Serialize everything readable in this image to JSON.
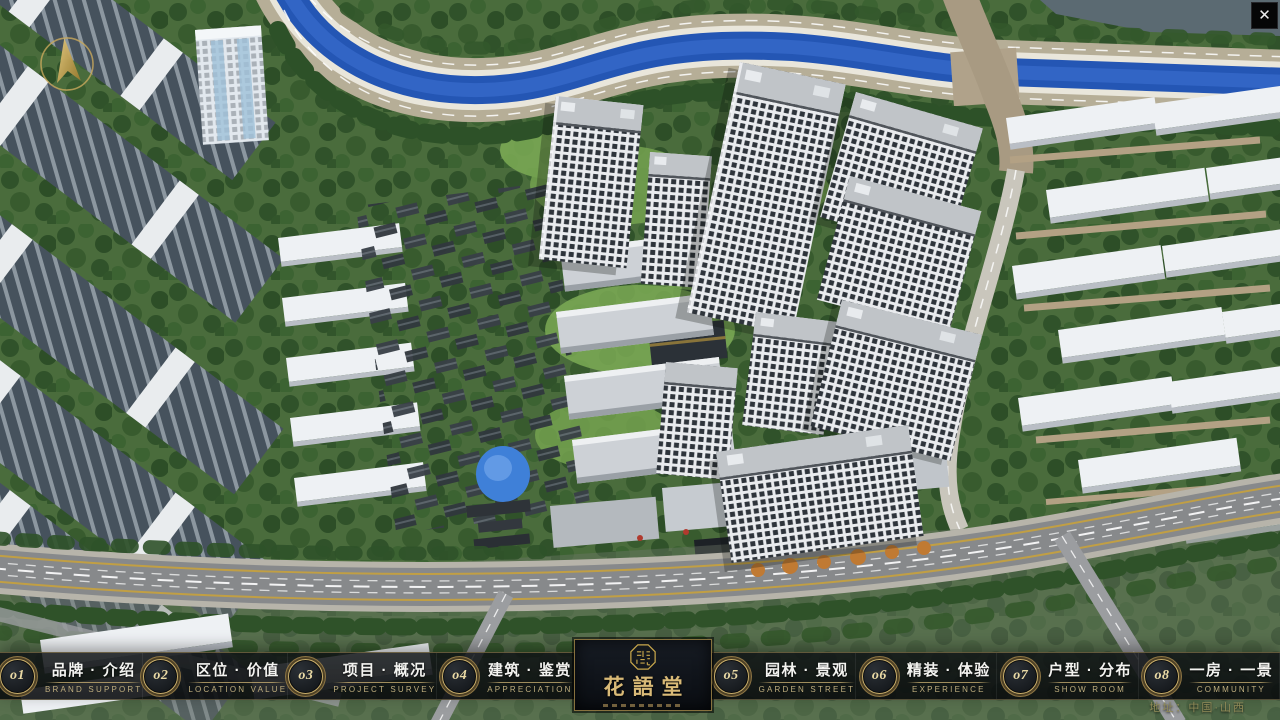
{
  "window": {
    "close_glyph": "✕"
  },
  "nav": {
    "items": [
      {
        "num": "o1",
        "zh": "品牌 · 介绍",
        "en": "BRAND SUPPORT"
      },
      {
        "num": "o2",
        "zh": "区位 · 价值",
        "en": "LOCATION VALUE"
      },
      {
        "num": "o3",
        "zh": "项目 · 概况",
        "en": "PROJECT SURVEY"
      },
      {
        "num": "o4",
        "zh": "建筑 · 鉴赏",
        "en": "APPRECIATION"
      },
      {
        "num": "o5",
        "zh": "园林 · 景观",
        "en": "GARDEN STREET"
      },
      {
        "num": "o6",
        "zh": "精装 · 体验",
        "en": "EXPERIENCE"
      },
      {
        "num": "o7",
        "zh": "户型 · 分布",
        "en": "SHOW ROOM"
      },
      {
        "num": "o8",
        "zh": "一房 · 一景",
        "en": "COMMUNITY"
      }
    ]
  },
  "logo": {
    "title": "花語堂"
  },
  "footer": {
    "address": "地址：中国·山西"
  },
  "colors": {
    "gold_accent": "#b89a5a",
    "bar_background": "rgba(10,13,16,0.84)",
    "logo_text": "#d9ba77",
    "river_water": "#2456b4",
    "address_text": "#918b58"
  }
}
